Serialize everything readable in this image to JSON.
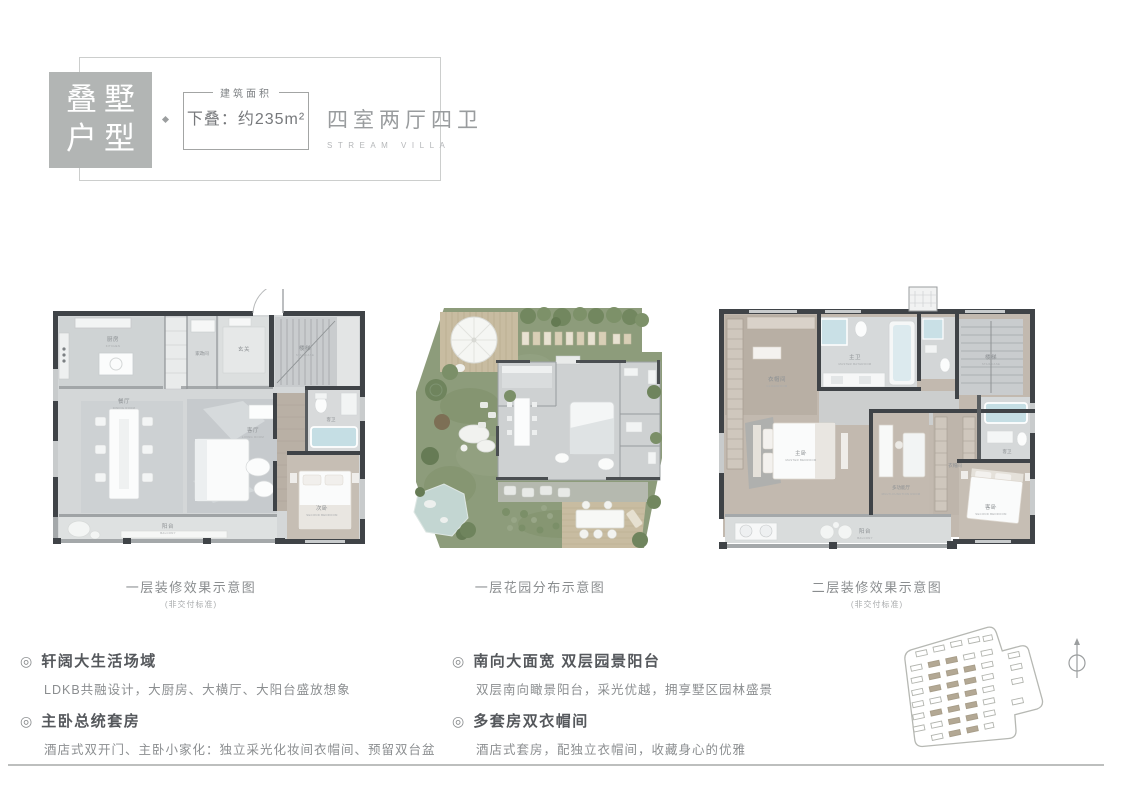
{
  "header": {
    "badge": {
      "line1": "叠墅",
      "line2": "户型"
    },
    "area_box": {
      "legend": "建筑面积",
      "value": "下叠：约235m²"
    },
    "type_title": "四室两厅四卫",
    "type_subtitle": "STREAM VILLA"
  },
  "plans": [
    {
      "caption": "一层装修效果示意图",
      "note": "(非交付标准)",
      "rooms": [
        {
          "label": "厨房",
          "en": "KITCHEN"
        },
        {
          "label": "家政间",
          "en": ""
        },
        {
          "label": "玄关",
          "en": ""
        },
        {
          "label": "楼梯",
          "en": "STAIRCASE"
        },
        {
          "label": "餐厅",
          "en": "DINING ROOM"
        },
        {
          "label": "客厅",
          "en": "LIVING ROOM"
        },
        {
          "label": "客卫",
          "en": ""
        },
        {
          "label": "次卧",
          "en": "SECOND BEDROOM"
        },
        {
          "label": "阳台",
          "en": "BALCONY"
        }
      ]
    },
    {
      "caption": "一层花园分布示意图",
      "note": "",
      "rooms": []
    },
    {
      "caption": "二层装修效果示意图",
      "note": "(非交付标准)",
      "rooms": [
        {
          "label": "衣帽间",
          "en": "CLOAKROOM"
        },
        {
          "label": "主卫",
          "en": "MASTER BATHROOM"
        },
        {
          "label": "楼梯",
          "en": "STAIRCASE"
        },
        {
          "label": "主卧",
          "en": "MASTER BEDROOM"
        },
        {
          "label": "多功能厅",
          "en": "MULTI-FUNCTION ROOM"
        },
        {
          "label": "衣帽间",
          "en": "CLOAKROOM"
        },
        {
          "label": "客卫",
          "en": ""
        },
        {
          "label": "客卧",
          "en": "SECOND BEDROOM"
        },
        {
          "label": "阳台",
          "en": "BALCONY"
        }
      ]
    }
  ],
  "features": {
    "bullet": "◎",
    "left": [
      {
        "title": "轩阔大生活场域",
        "desc": "LDKB共融设计，大厨房、大横厅、大阳台盛放想象"
      },
      {
        "title": "主卧总统套房",
        "desc": "酒店式双开门、主卧小家化：独立采光化妆间衣帽间、预留双台盆"
      }
    ],
    "right": [
      {
        "title": "南向大面宽 双层园景阳台",
        "desc": "双层南向瞰景阳台，采光优越，拥享墅区园林盛景"
      },
      {
        "title": "多套房双衣帽间",
        "desc": "酒店式套房，配独立衣帽间，收藏身心的优雅"
      }
    ]
  },
  "colors": {
    "badge_bg": "#b2b5b4",
    "wall": "#3f4347",
    "floor_gray": "#d4d7d8",
    "floor_wood": "#c1b8ae",
    "garden_green": "#8d9c7b",
    "deck_tan": "#c8bca1",
    "water_blue": "#c5dee4",
    "site_fill": "#b3a894"
  }
}
